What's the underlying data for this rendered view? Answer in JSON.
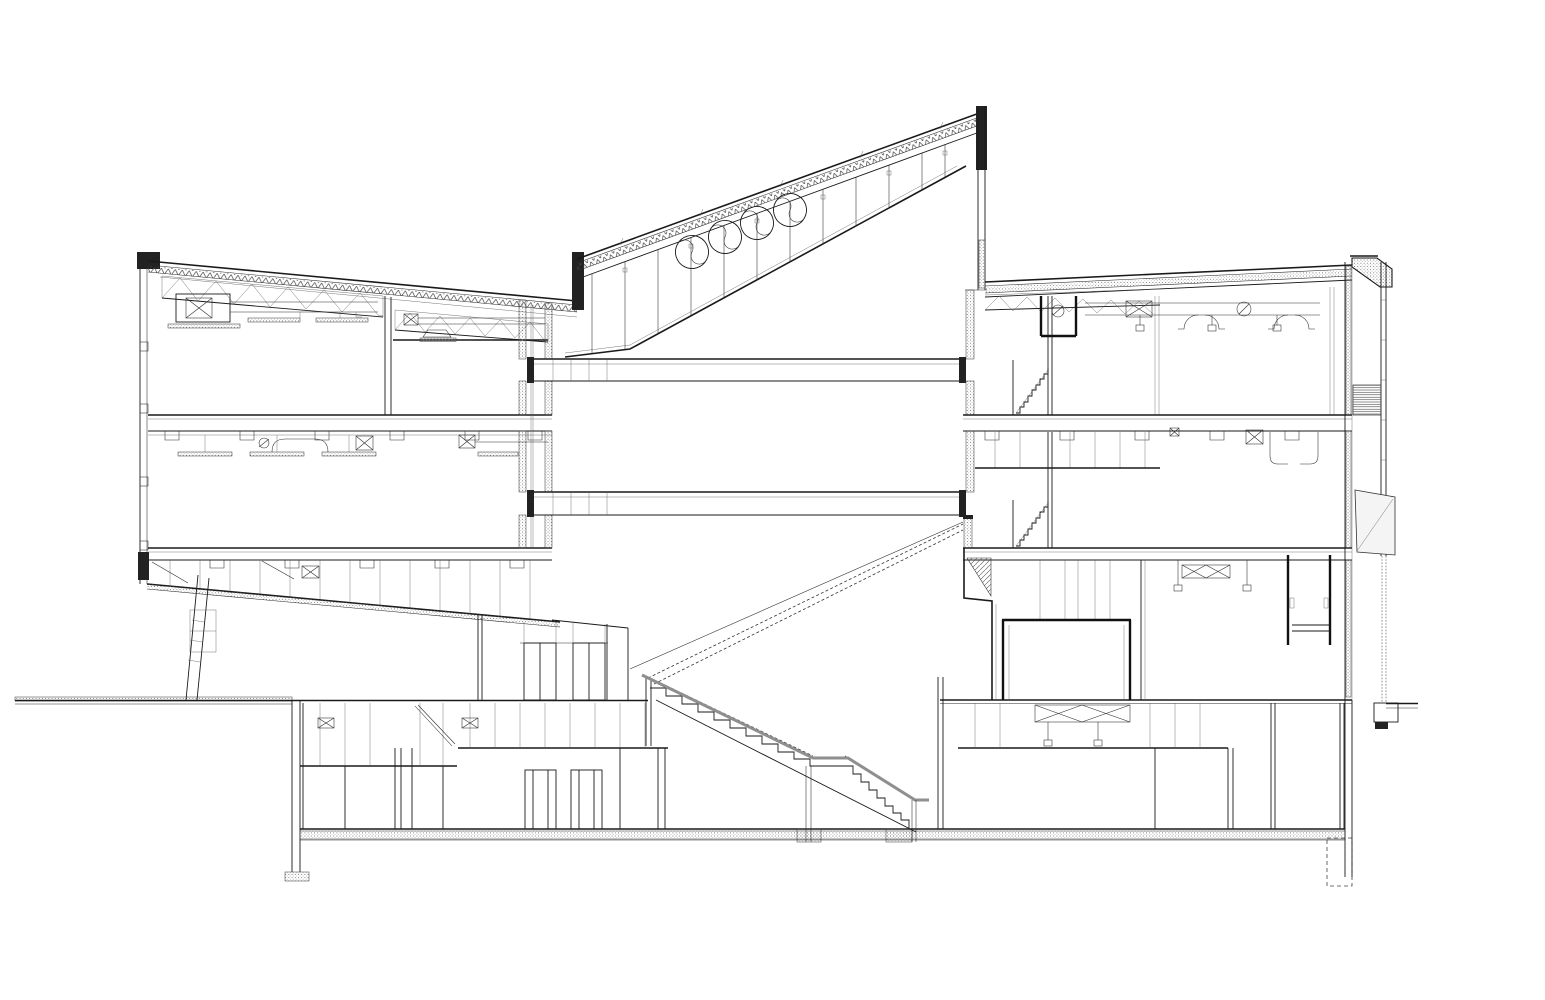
{
  "document": {
    "kind": "architectural-section-drawing",
    "style": "black-and-white CAD line drawing, no visible text",
    "aria_label": "Architectural cross-section of a multi-storey building: left wing with two office levels and roof trusses, central full-height atrium with a rising clerestory roof containing four circular fan windows, two atrium bridges, a grand tribune stair rising to the right tower, a stair descending to the basement, a right tower with three levels, double-skin east facade with louvres and a tilted shading panel, and a continuous basement level"
  },
  "palette": {
    "background": "#ffffff",
    "line_main": "#1a1a1a",
    "line_medium": "#2a2a2a",
    "line_light": "#555555",
    "handrail_grey": "#8f8f8f",
    "solid_fill_dark": "#222222",
    "hatch_dot": "#666666"
  },
  "counts": {
    "clerestory_fan_circles": 4,
    "clerestory_mullions": 12,
    "atrium_bridges": 2,
    "left_wing_levels": 2,
    "right_tower_levels": 3,
    "basement_levels": 1,
    "hvac_cross_boxes": 10,
    "roof_trusses": 3
  },
  "components": {
    "left_wing": "two-level wing, sloped roof with insulation hatch and steel trusses, rooftop AHU unit, ceiling ducts and diffusers, cantilevered sloping underside with raking strut",
    "atrium": "central void under mono-pitch clerestory; four circular fans in glazing band; two floor bridges; dashed hidden tribune stair rising left-to-right; solid stair with grey handrail descending to basement",
    "right_tower": "three levels, slightly rising roof with truss zone, ceiling ducts with round dampers, two short stair flights at atrium wall, bold-walled hall at ground level, elevator/shaft box, double-skin east facade with louvre block and tilted panel",
    "basement": "partitioned rooms, suspended ceilings, duct cross-boxes, hatched floor slab and footings",
    "site": "ground line extending left and right of the building, dashed footing at right"
  }
}
